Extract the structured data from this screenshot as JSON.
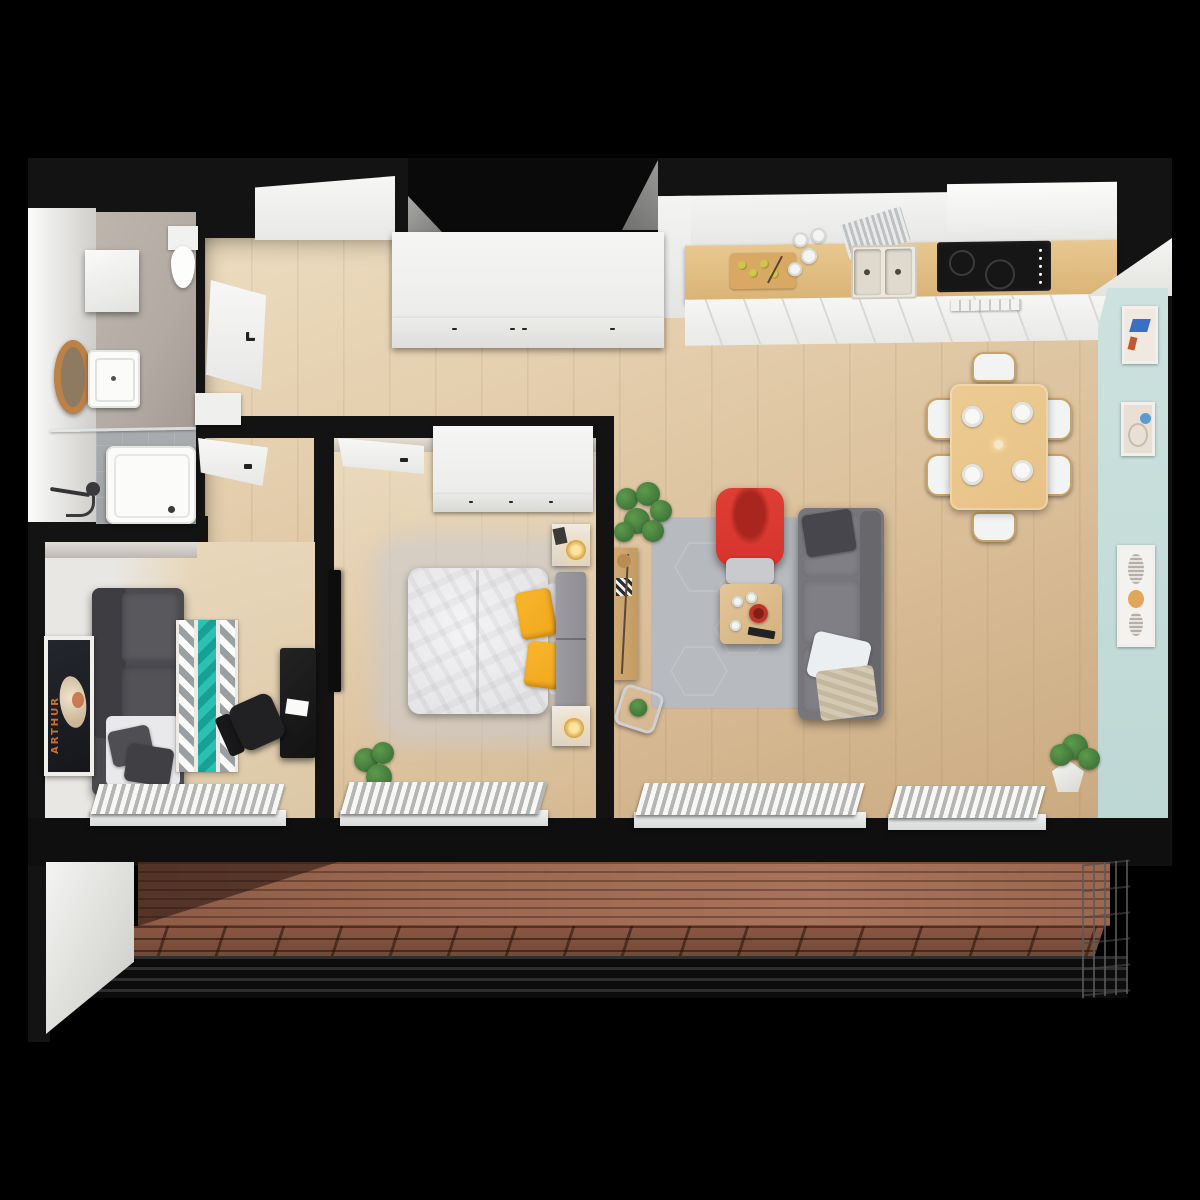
{
  "scene": {
    "type": "3d-apartment-floorplan-render",
    "view": "top-down",
    "background": "black"
  },
  "poster": {
    "text": "ARTHUR"
  },
  "colors": {
    "bg": "#000000",
    "wall": "#131313",
    "wood": "#dcc19c",
    "wood-dark": "#c9a87e",
    "wood-light": "#ecdcbf",
    "deck": "#9b6750",
    "deck-dark": "#6b4433",
    "accent-wall": "#bdd7d4",
    "tile-beige": "#b3aaa3",
    "tile-floor": "#9fa3a6",
    "rug-gray": "#b7babe",
    "rug-teal": "#27bdb0",
    "sofa-gray": "#77767b",
    "daybed-gray": "#4b4b4f",
    "chair-red": "#d5342c",
    "pillow-yellow": "#f2a71c",
    "table-wood": "#e7c287",
    "cabinet-white": "#f3f3f2",
    "radiator-white": "#f0f0ef",
    "plant-green": "#41773a",
    "poster-orange": "#d8742f",
    "lamp-gold": "#d9a94e"
  },
  "rooms": [
    {
      "name": "bathroom",
      "items": [
        "wall-shelf-cabinet",
        "toilet",
        "round-wood-mirror",
        "washbasin",
        "bathtub",
        "shower-handset",
        "glass-partition"
      ]
    },
    {
      "name": "entry-hall",
      "items": [
        "entrance-door-recess",
        "hall-closet",
        "bathroom-door-open",
        "hall-cabinet"
      ]
    },
    {
      "name": "kitchen",
      "items": [
        "tall-cabinet",
        "upper-cabinets",
        "wood-countertop",
        "cutting-board-with-lemons",
        "canisters",
        "dish-rack",
        "double-sink",
        "induction-cooktop",
        "vent-drawer"
      ]
    },
    {
      "name": "living-dining-room",
      "items": [
        "dining-table",
        "six-chairs",
        "four-plates",
        "hexagon-area-rug",
        "gray-sofa",
        "red-armchair",
        "coffee-table",
        "remote-control",
        "monstera-plant",
        "sideboard",
        "plant-side-table",
        "potted-plant",
        "two-radiators",
        "blue-accent-wall",
        "three-picture-frames"
      ]
    },
    {
      "name": "bedroom",
      "items": [
        "white-wardrobe",
        "open-door",
        "double-bed",
        "white-duvet",
        "two-yellow-pillows",
        "gray-headboard",
        "two-nightstands-with-lamps",
        "fluffy-gray-rug",
        "wall-mounted-tv",
        "floor-plant",
        "radiator"
      ]
    },
    {
      "name": "home-office",
      "items": [
        "dark-daybed-sofa",
        "teal-zigzag-rug",
        "black-desk",
        "office-chair",
        "arthur-poster",
        "radiator"
      ]
    },
    {
      "name": "balcony",
      "items": [
        "wood-plank-decking",
        "deck-tiles",
        "metal-railing",
        "wire-fence",
        "white-side-wall"
      ]
    }
  ]
}
